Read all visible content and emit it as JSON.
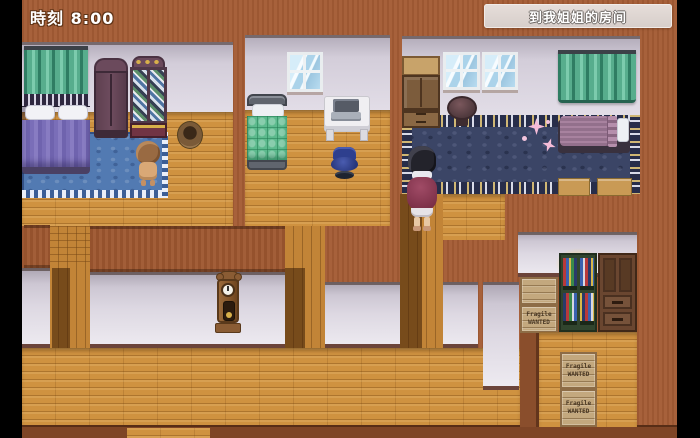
{
  "hud": {
    "time": "時刻 8:00",
    "quest": "到我姐姐的房间"
  },
  "crates": {
    "line1": "Fragile",
    "line2": "WANTED"
  },
  "palette": {
    "letterbox": "#000000",
    "wall_brown": "#a45c35",
    "wall_plaster": "#ddd8e2",
    "floor_wood": "#cf9240",
    "carpet_blue": "#527ab2",
    "carpet_navy": "#3b4566",
    "curtain_green": "#57ad8d",
    "bed_green": "#5cba8d",
    "bed_purple": "#7a6eb8",
    "bed_mauve": "#a07c9a",
    "sparkle_pink": "#f6bcd8",
    "banner_bg": "#ded5d1",
    "hud_text": "#ffffff"
  }
}
